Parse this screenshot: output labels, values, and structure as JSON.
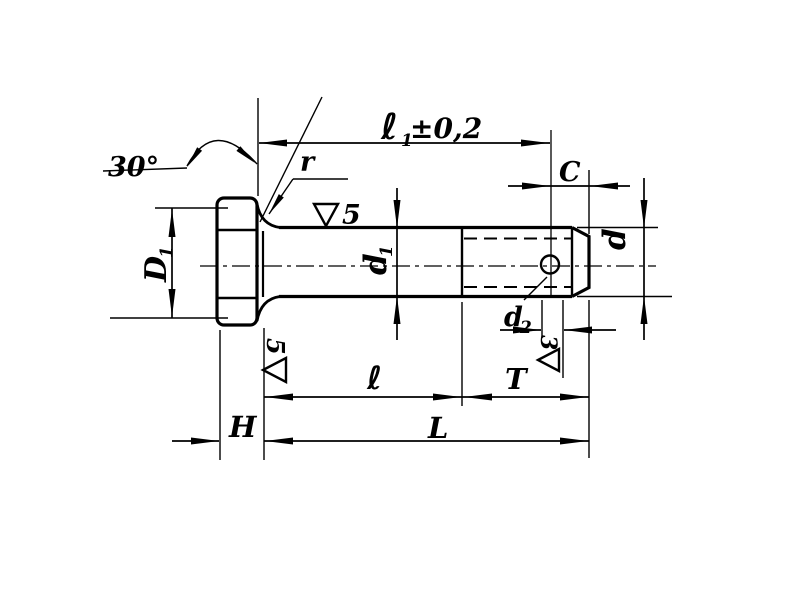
{
  "page": {
    "background": "#ffffff",
    "ink": "#000000"
  },
  "drawing": {
    "type": "engineering drawing of hex-head bolt with cotter-pin hole",
    "labels": {
      "angle_30": "30°",
      "fillet_r": "r",
      "l1_base": "ℓ",
      "l1_sub": "1",
      "l1_tol": "±0,2",
      "c": "C",
      "d": "d",
      "d1_base": "d",
      "d1_sub": "1",
      "d2_base": "d",
      "d2_sub": "2",
      "D1_base": "D",
      "D1_sub": "1",
      "l": "ℓ",
      "t": "T",
      "big_l": "L",
      "h": "H",
      "finish_shank": "5",
      "finish_head": "5",
      "finish_end": "3"
    }
  }
}
